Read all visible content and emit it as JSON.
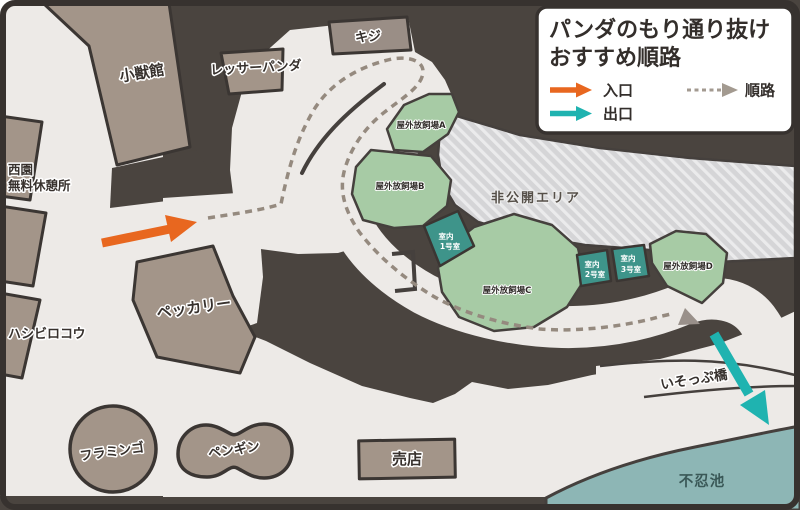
{
  "legend": {
    "title_line1": "パンダのもり通り抜け",
    "title_line2": "おすすめ順路",
    "entrance_label": "入口",
    "exit_label": "出口",
    "route_label": "順路"
  },
  "map": {
    "labels": {
      "small_mammal_house": "小獣館",
      "pheasant": "キジ",
      "red_panda": "レッサーパンダ",
      "west_rest_area_line1": "西園",
      "west_rest_area_line2": "無料休憩所",
      "shoebill": "ハシビロコウ",
      "peccary": "ペッカリー",
      "flamingo": "フラミンゴ",
      "penguin": "ペンギン",
      "shop": "売店",
      "private_area": "非公開エリア",
      "outdoor_a": "屋外放飼場A",
      "outdoor_b": "屋外放飼場B",
      "outdoor_c": "屋外放飼場C",
      "outdoor_d": "屋外放飼場D",
      "indoor1_line1": "室内",
      "indoor1_line2": "1号室",
      "indoor2_line1": "室内",
      "indoor2_line2": "2号室",
      "indoor3_line1": "室内",
      "indoor3_line2": "3号室",
      "bridge": "いそっぷ橋",
      "pond": "不忍池"
    },
    "colors": {
      "background": "#4a443f",
      "path": "#edeae7",
      "building": "#a39589",
      "enclosure_green": "#a7cba5",
      "indoor_teal": "#3e948a",
      "private_hatch": "#d5d5d7",
      "pond": "#8db6b5",
      "entrance_orange": "#e8671f",
      "exit_teal": "#1fb3b0",
      "route_dash": "#958a7f",
      "outline": "#3b3633"
    }
  }
}
